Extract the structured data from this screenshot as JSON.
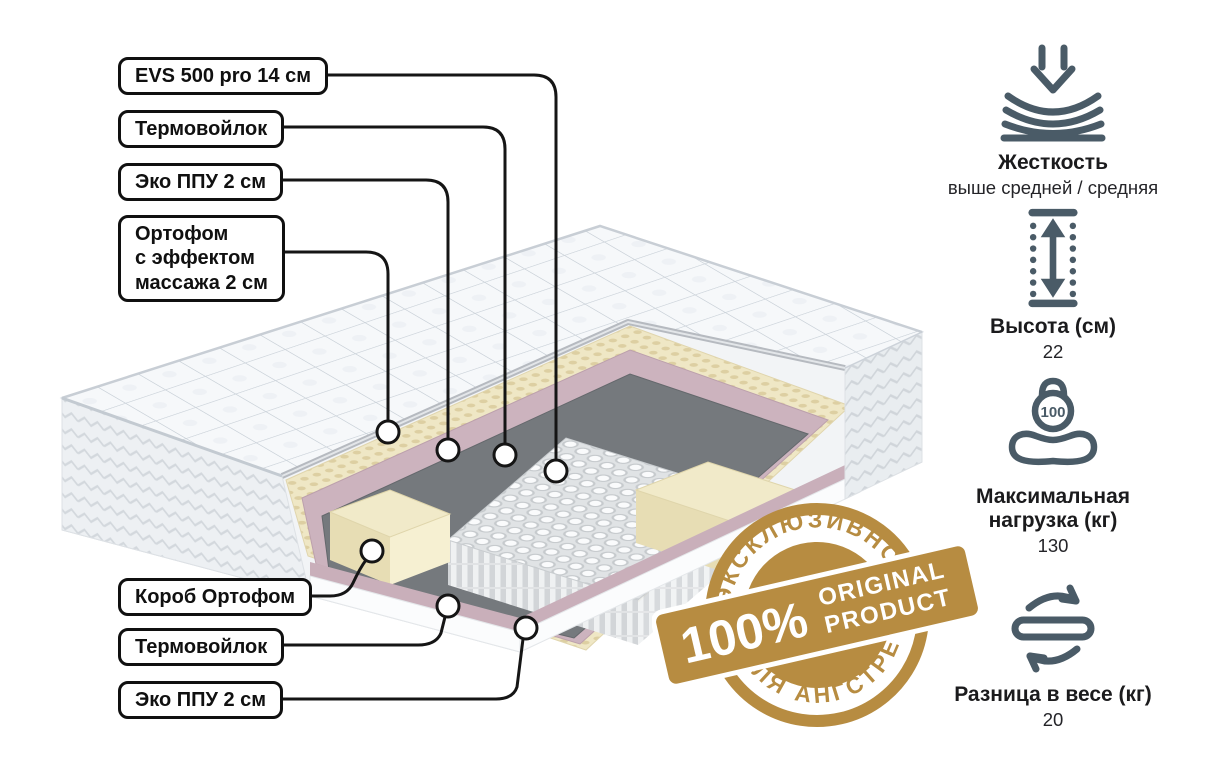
{
  "illustration": {
    "description": "cutaway mattress showing inner layers",
    "labels": [
      {
        "text": "EVS 500 pro 14 см"
      },
      {
        "text": "Термовойлок"
      },
      {
        "text": "Эко ППУ 2 см"
      },
      {
        "text": "Ортофом\nс эффектом\nмассажа 2 см"
      },
      {
        "text": "Короб Ортофом"
      },
      {
        "text": "Термовойлок"
      },
      {
        "text": "Эко ППУ 2 см"
      }
    ]
  },
  "specs": [
    {
      "icon": "firmness-icon",
      "title": "Жесткость",
      "value": "выше средней / средняя"
    },
    {
      "icon": "height-icon",
      "title": "Высота (см)",
      "value": "22"
    },
    {
      "icon": "max-load-icon",
      "icon_number": "100",
      "title": "Максимальная нагрузка (кг)",
      "value": "130"
    },
    {
      "icon": "flip-icon",
      "title": "Разница в весе (кг)",
      "value": "20"
    }
  ],
  "badge": {
    "arc_top": "ЭКСКЛЮЗИВНО",
    "percent": "100%",
    "original": "ORIGINAL",
    "product": "PRODUCT",
    "arc_bottom": "ДЛЯ АНГСТРЕМ"
  },
  "colors": {
    "gold": "#b78c41",
    "icon_slate": "#4a5b67",
    "callout_line": "#151515",
    "quilt_white": "#f6f8fa",
    "foam_cream": "#efe7c5",
    "eco_pink": "#ccb3be",
    "felt_gray": "#75797d"
  }
}
